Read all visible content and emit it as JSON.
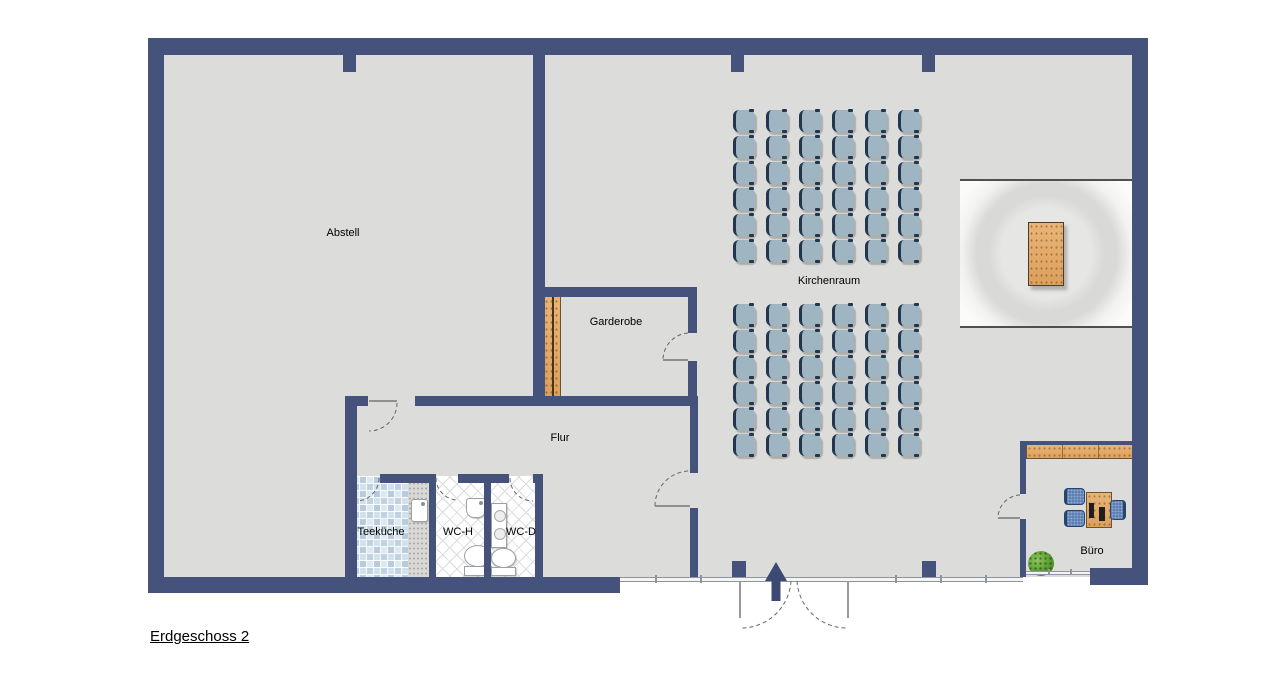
{
  "title": "Erdgeschoss 2",
  "floor": {
    "rooms": {
      "abstell": "Abstell",
      "garderobe": "Garderobe",
      "flur": "Flur",
      "teekueche": "Teeküche",
      "wc_h": "WC-H",
      "wc_d": "WC-D",
      "kirchenraum": "Kirchenraum",
      "buero": "Büro"
    },
    "seating": {
      "blocks": [
        {
          "rows": 6,
          "cols": 6
        },
        {
          "rows": 6,
          "cols": 6
        }
      ],
      "total_chairs": 72
    },
    "colors": {
      "wall": "#45527c",
      "floor": "#dcdcda",
      "chair": "#9fb5c1",
      "wood": "#e0a768",
      "office_chair": "#5e80b4",
      "plant": "#55982f",
      "tile_blue": "#b6cbdd"
    }
  }
}
